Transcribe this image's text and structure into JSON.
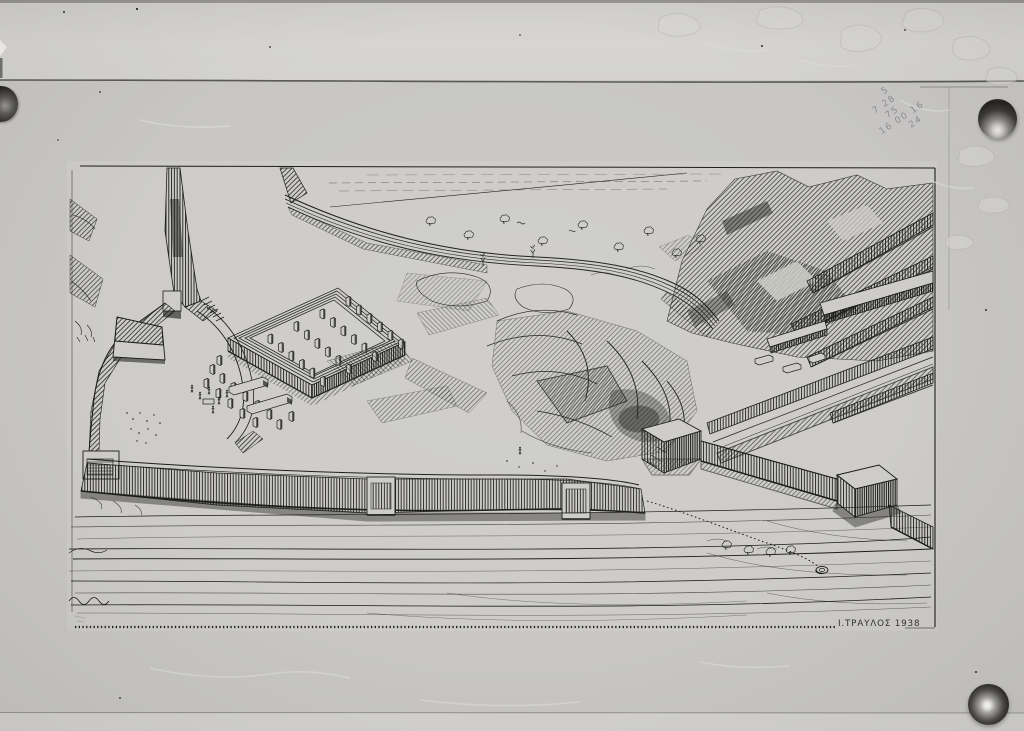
{
  "meta": {
    "description": "Black-and-white archival photograph of a pen-and-ink bird's-eye reconstruction drawing of an ancient walled hillside site, held to a board by three thumbtacks"
  },
  "drawing": {
    "signature": "Ι.ΤΡΑΥΛΟΣ 1938",
    "signature_name": "Ι.ΤΡΑΥΛΟΣ",
    "signature_year": "1938"
  },
  "annotations": {
    "pencil_lines": [
      "5",
      "7 28",
      "75",
      "16 00 16",
      "24"
    ]
  },
  "colors": {
    "board_gray": "#c8c7c5",
    "top_band_gray": "#d5d4d2",
    "bottom_band_gray": "#d3d2d0",
    "drawing_paper": "#cdccc8",
    "ink": "#1b1b19",
    "pin_metal_dark": "#2e2e2c",
    "pencil_gray": "#8b8b90"
  },
  "icons": [
    "thumbtack-pin"
  ]
}
